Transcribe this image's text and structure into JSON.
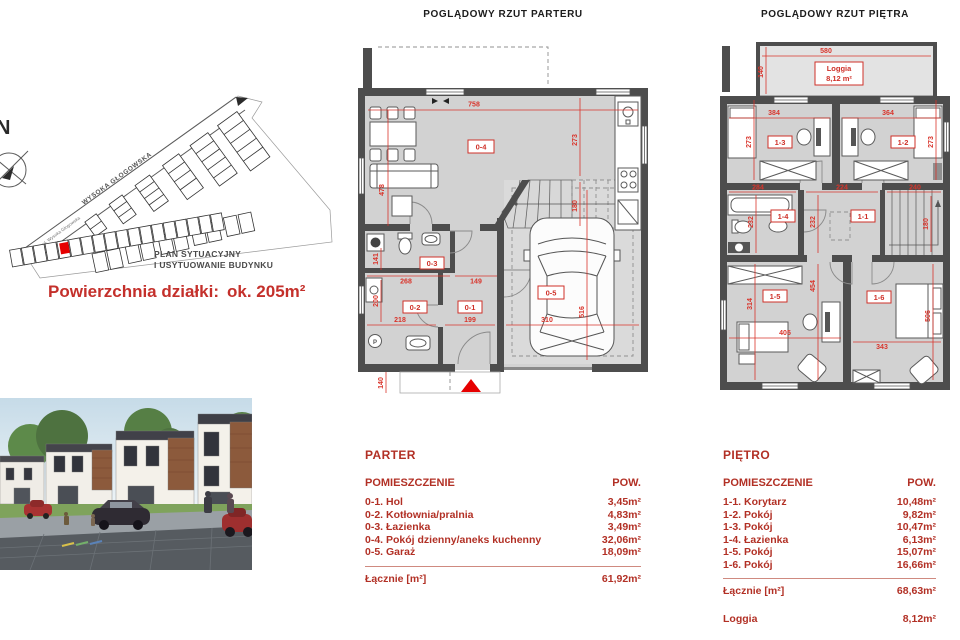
{
  "headings": {
    "ground": "POGLĄDOWY RZUT PARTERU",
    "upper": "POGLĄDOWY RZUT PIĘTRA"
  },
  "site_plan": {
    "north": "N",
    "street_main": "WYSOKA GŁOGOWSKA",
    "street_small": "ul. Wysoka Głogowska",
    "caption1": "PLAN SYTUACYJNY",
    "caption2": "I USYTUOWANIE BUDYNKU",
    "area_label": "Powierzchnia działki:",
    "area_value": "ok. 205m²"
  },
  "ground_floor": {
    "rooms": [
      "0-1",
      "0-2",
      "0-3",
      "0-4",
      "0-5"
    ],
    "p_symbol": "P",
    "dims": {
      "w_top": "758",
      "h_left": "478",
      "h_kitchen": "273",
      "h_stairs": "180",
      "w_bath": "268",
      "w_nook": "149",
      "h_bath": "141",
      "w_boiler": "218",
      "h_boiler": "200",
      "w_hall": "199",
      "w_garage": "310",
      "h_garage": "516",
      "h_porch": "140"
    }
  },
  "upper_floor": {
    "loggia_name": "Loggia",
    "loggia_area": "8,12 m²",
    "rooms": [
      "1-1",
      "1-2",
      "1-3",
      "1-4",
      "1-5",
      "1-6"
    ],
    "dims": {
      "w_loggia": "580",
      "h_loggia": "140",
      "w_r3": "384",
      "w_r2": "364",
      "h_r3": "273",
      "h_r2": "273",
      "w_bath": "284",
      "h_bath": "232",
      "w_corr": "224",
      "h_corr": "232",
      "w_stairs": "240",
      "h_stairs": "180",
      "h_mid": "454",
      "h_r5": "314",
      "w_r5": "405",
      "w_r6": "343",
      "h_r6": "506"
    }
  },
  "parter_table": {
    "title": "PARTER",
    "col_room": "POMIESZCZENIE",
    "col_area": "POW.",
    "rows": [
      {
        "name": "0-1. Hol",
        "area": "3,45m²"
      },
      {
        "name": "0-2. Kotłownia/pralnia",
        "area": "4,83m²"
      },
      {
        "name": "0-3. Łazienka",
        "area": "3,49m²"
      },
      {
        "name": "0-4. Pokój dzienny/aneks kuchenny",
        "area": "32,06m²"
      },
      {
        "name": "0-5. Garaż",
        "area": "18,09m²"
      }
    ],
    "total_label": "Łącznie [m²]",
    "total_value": "61,92m²"
  },
  "pietro_table": {
    "title": "PIĘTRO",
    "col_room": "POMIESZCZENIE",
    "col_area": "POW.",
    "rows": [
      {
        "name": "1-1. Korytarz",
        "area": "10,48m²"
      },
      {
        "name": "1-2. Pokój",
        "area": "9,82m²"
      },
      {
        "name": "1-3. Pokój",
        "area": "10,47m²"
      },
      {
        "name": "1-4. Łazienka",
        "area": "6,13m²"
      },
      {
        "name": "1-5. Pokój",
        "area": "15,07m²"
      },
      {
        "name": "1-6. Pokój",
        "area": "16,66m²"
      }
    ],
    "total_label": "Łącznie [m²]",
    "total_value": "68,63m²",
    "loggia_label": "Loggia",
    "loggia_value": "8,12m²"
  }
}
